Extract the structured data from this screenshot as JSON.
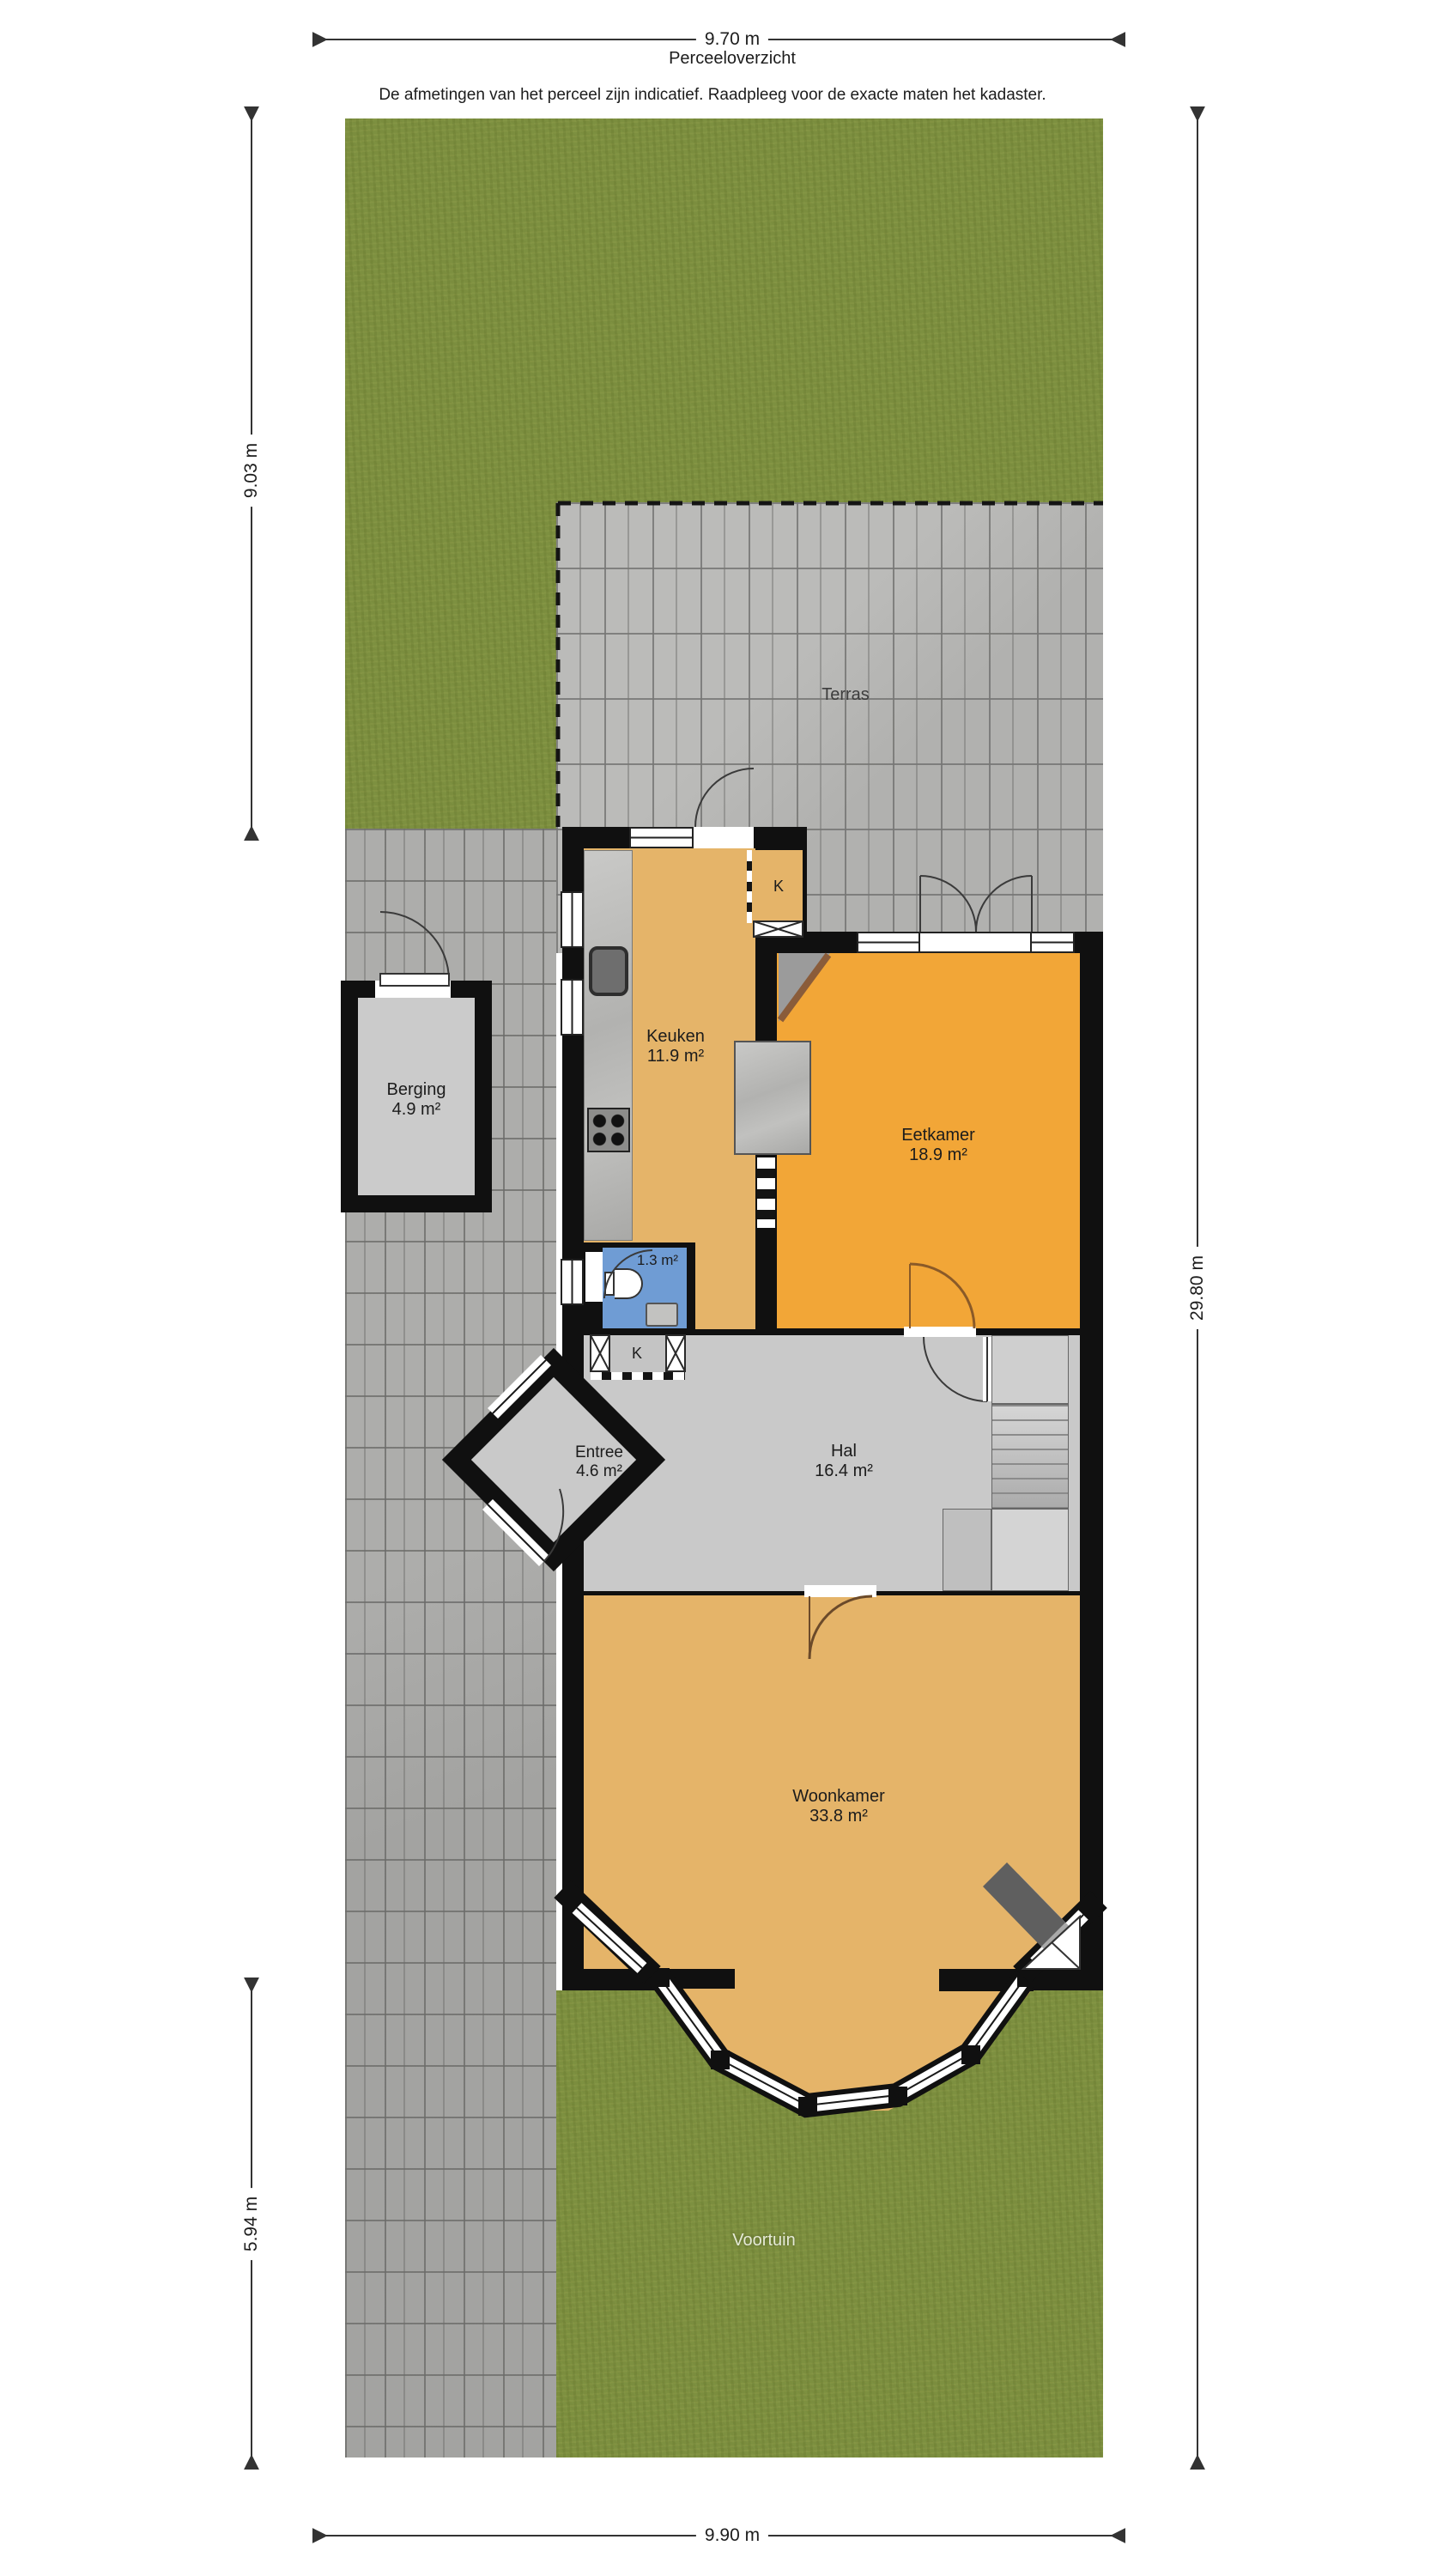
{
  "header": {
    "top_dimension": "9.70 m",
    "title": "Perceeloverzicht",
    "disclaimer": "De afmetingen van het perceel zijn indicatief. Raadpleeg voor de exacte maten het kadaster."
  },
  "dimensions": {
    "left_upper": "9.03 m",
    "left_lower": "5.94 m",
    "right": "29.80 m",
    "bottom": "9.90 m"
  },
  "garden": {
    "terrace_label": "Terras",
    "front_garden_label": "Voortuin"
  },
  "rooms": {
    "berging": {
      "name": "Berging",
      "area": "4.9 m²"
    },
    "keuken": {
      "name": "Keuken",
      "area": "11.9 m²"
    },
    "eetkamer": {
      "name": "Eetkamer",
      "area": "18.9 m²"
    },
    "toilet": {
      "area": "1.3 m²"
    },
    "entree": {
      "name": "Entree",
      "area": "4.6 m²"
    },
    "hal": {
      "name": "Hal",
      "area": "16.4 m²"
    },
    "woonkamer": {
      "name": "Woonkamer",
      "area": "33.8 m²"
    },
    "closet_upper": {
      "label": "K"
    },
    "closet_lower": {
      "label": "K"
    }
  },
  "colors": {
    "grass": "#7d9040",
    "terrace_tile": "#b5b5b3",
    "driveway_tile": "#a9a9a7",
    "wall": "#101010",
    "floor_kitchen_living": "#e5b469",
    "floor_dining": "#f2a637",
    "floor_hall": "#c9c9c9",
    "floor_toilet": "#6f9cd4",
    "dimension_line": "#333333"
  }
}
